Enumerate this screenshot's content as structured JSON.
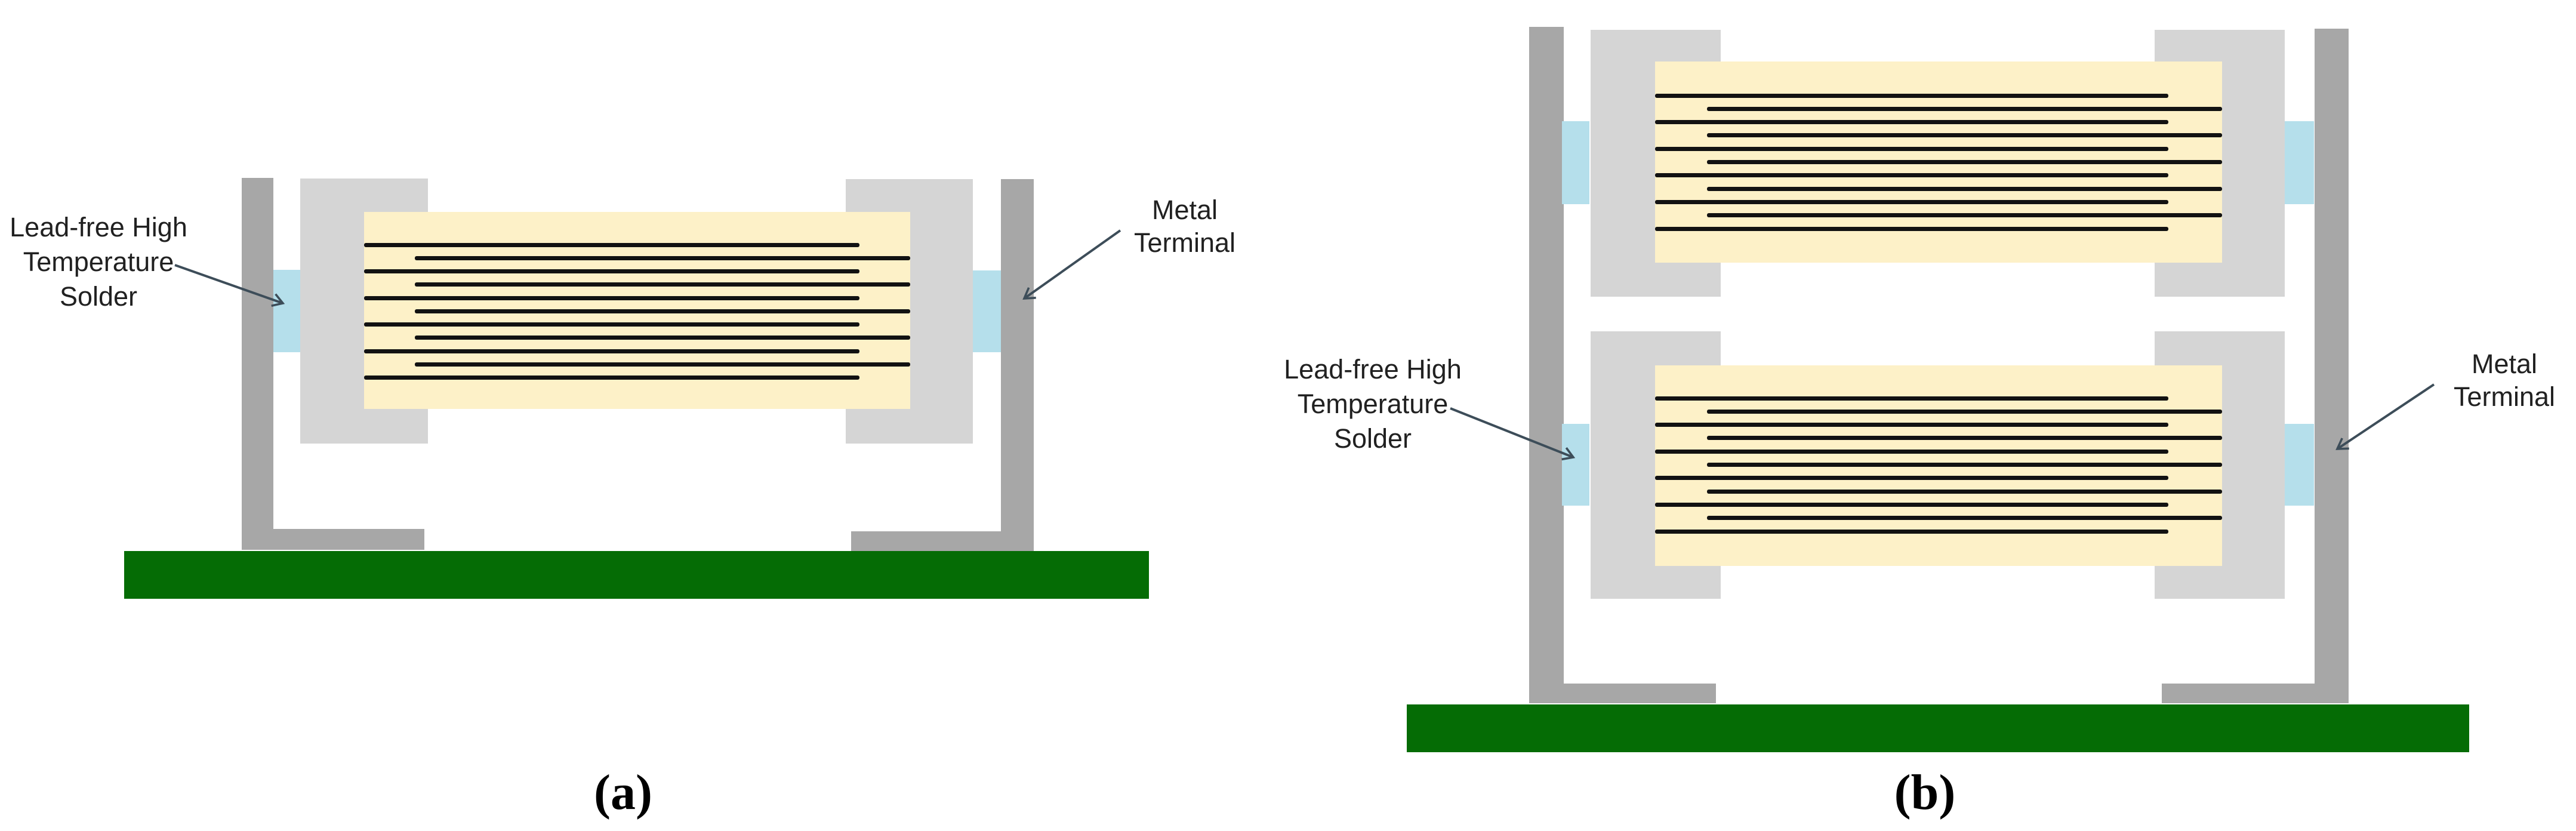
{
  "figure": {
    "type": "diagram",
    "description": "Cross-section schematic of MLCC capacitors with metal terminals soldered to a PCB",
    "panel_count": 2
  },
  "panel_a": {
    "caption": "(a)",
    "capacitor_count": 1,
    "labels": {
      "solder_line1": "Lead-free High",
      "solder_line2": "Temperature",
      "solder_line3": "Solder",
      "terminal_line1": "Metal",
      "terminal_line2": "Terminal"
    }
  },
  "panel_b": {
    "caption": "(b)",
    "capacitor_count": 2,
    "labels": {
      "solder_line1": "Lead-free High",
      "solder_line2": "Temperature",
      "solder_line3": "Solder",
      "terminal_line1": "Metal",
      "terminal_line2": "Terminal"
    }
  },
  "components": {
    "electrode_count": 11,
    "ceramic_body": "ceramic dielectric block",
    "electrodes": "interleaved internal electrodes",
    "end_termination": "capacitor end termination",
    "solder_joint": "lead-free high temperature solder joint",
    "metal_terminal": "L-shaped metal terminal lead",
    "board": "printed circuit board"
  },
  "colors": {
    "terminal_gray": "#a7a7a7",
    "endcap_gray": "#d5d5d5",
    "ceramic_cream": "#fdf1c8",
    "solder_blue": "#b5dfeb",
    "pcb_green": "#056c05",
    "electrode_black": "#121212",
    "label_text": "#212121",
    "arrow": "#3d4d59",
    "background": "#ffffff"
  }
}
